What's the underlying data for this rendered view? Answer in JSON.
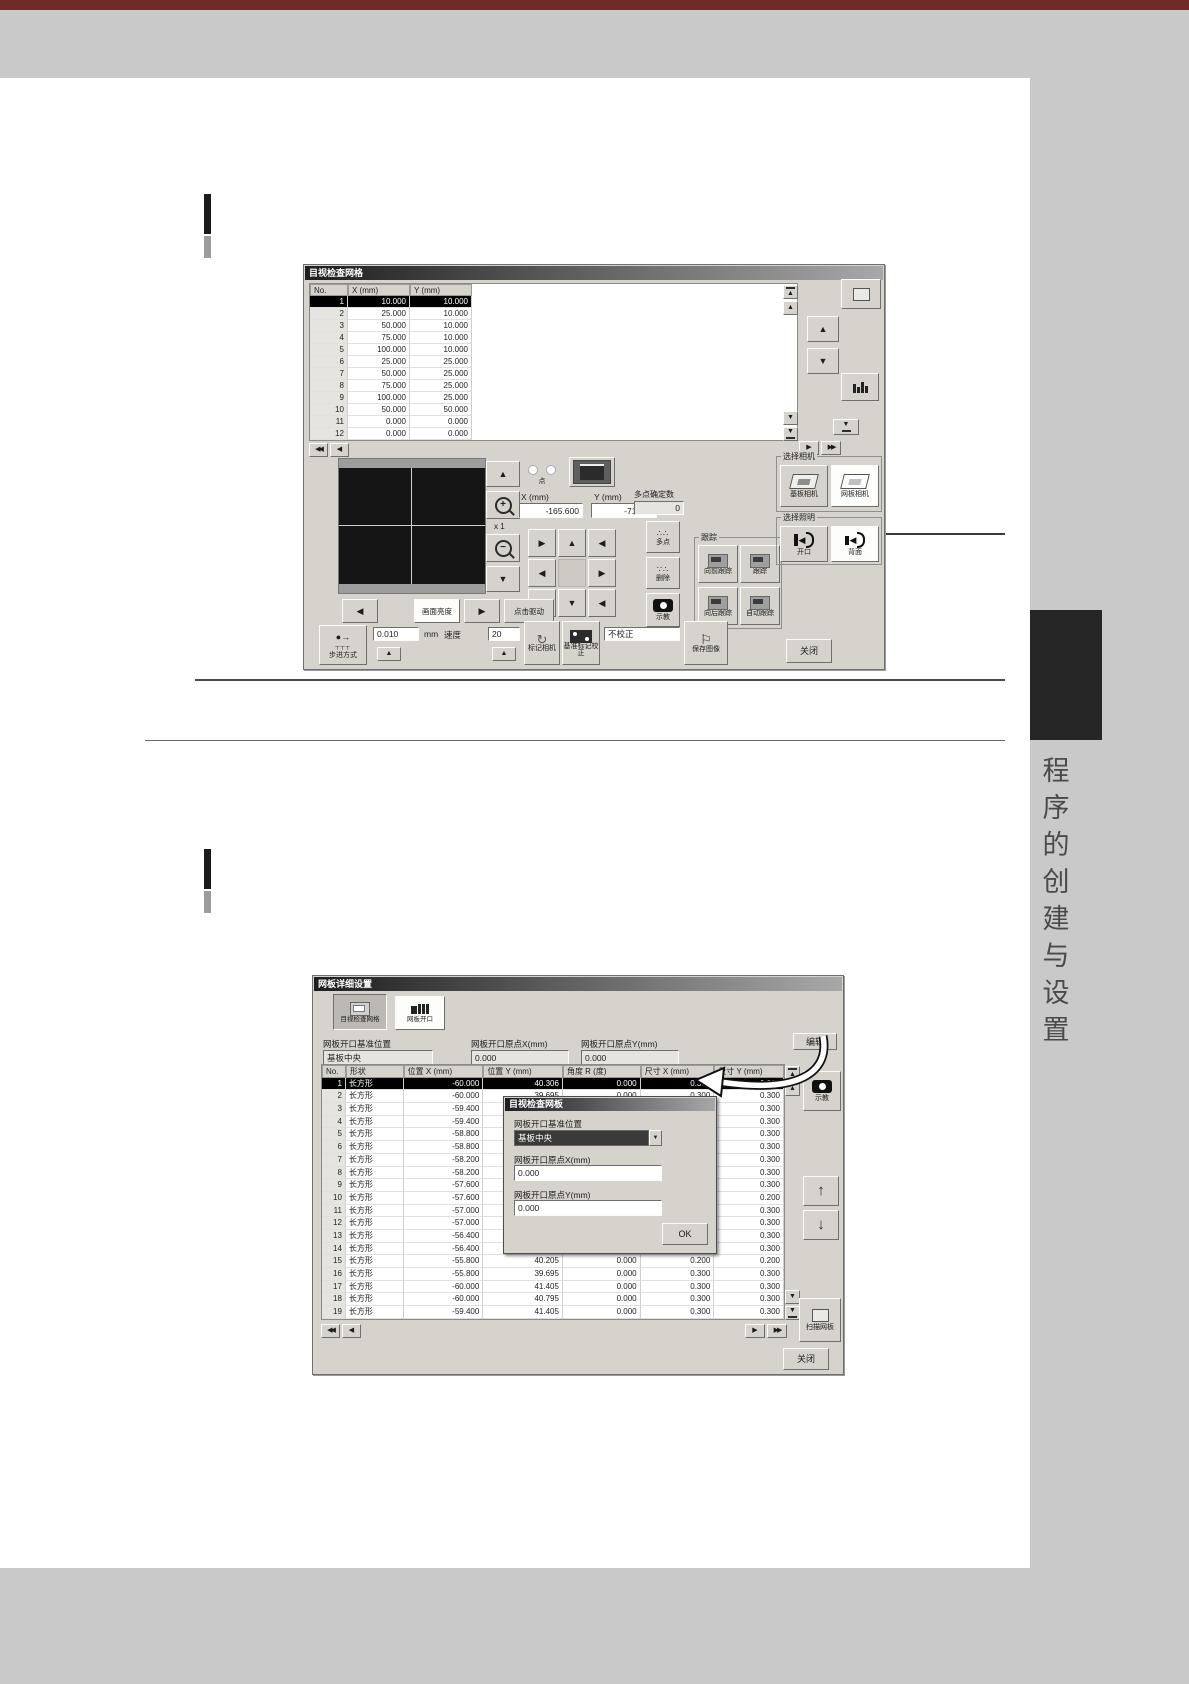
{
  "page": {
    "sidebar_chars": [
      "程",
      "序",
      "的",
      "创",
      "建",
      "与",
      "设",
      "置"
    ]
  },
  "icons": {
    "up": "▲",
    "down": "▼",
    "left": "◀",
    "right": "▶",
    "up_arrow": "↑",
    "down_arrow": "↓",
    "plus": "+",
    "minus": "−",
    "refresh": "↻",
    "flag": "⚐",
    "step": "●→"
  },
  "shot1": {
    "title": "目视检查网格",
    "table": {
      "headers": [
        "No.",
        "X (mm)",
        "Y (mm)"
      ],
      "rows": [
        [
          "1",
          "10.000",
          "10.000"
        ],
        [
          "2",
          "25.000",
          "10.000"
        ],
        [
          "3",
          "50.000",
          "10.000"
        ],
        [
          "4",
          "75.000",
          "10.000"
        ],
        [
          "5",
          "100.000",
          "10.000"
        ],
        [
          "6",
          "25.000",
          "25.000"
        ],
        [
          "7",
          "50.000",
          "25.000"
        ],
        [
          "8",
          "75.000",
          "25.000"
        ],
        [
          "9",
          "100.000",
          "25.000"
        ],
        [
          "10",
          "50.000",
          "50.000"
        ],
        [
          "11",
          "0.000",
          "0.000"
        ],
        [
          "12",
          "0.000",
          "0.000"
        ]
      ]
    },
    "pos": {
      "dot_label": "点",
      "x_label": "X (mm)",
      "x_value": "-165.600",
      "y_label": "Y (mm)",
      "y_value": "-71.004",
      "multi_label": "多点确定数",
      "multi_value": "0"
    },
    "zoom_scale": "x 1",
    "buttons": {
      "brightness": "画面亮度",
      "click_drive": "点击驱动",
      "multi_point": "多点",
      "delete": "删除",
      "teach": "示教",
      "step_mode": "步进方式",
      "step_value": "0.010",
      "unit": "mm",
      "speed_label": "速度",
      "speed_value": "20",
      "mark_camera": "标记相机",
      "fid_correct": "基准标记校正",
      "no_correct": "不校正",
      "save_image": "保存图像",
      "close": "关闭"
    },
    "groups": {
      "tracking": {
        "label": "跟踪",
        "items": [
          "向前跟踪",
          "跟踪",
          "向后跟踪",
          "自动跟踪"
        ]
      },
      "camera": {
        "label": "选择相机",
        "items": [
          "基板相机",
          "网板相机"
        ]
      },
      "light": {
        "label": "选择照明",
        "items": [
          "开口",
          "背面"
        ]
      }
    }
  },
  "shot2": {
    "title": "网板详细设置",
    "toolbar": {
      "btn_grid": "目视检查网格",
      "btn_aperture": "网板开口"
    },
    "header": {
      "ref_label": "网板开口基准位置",
      "ref_value": "基板中央",
      "ox_label": "网板开口原点X(mm)",
      "ox_value": "0.000",
      "oy_label": "网板开口原点Y(mm)",
      "oy_value": "0.000",
      "edit": "编辑"
    },
    "table": {
      "headers": [
        "No.",
        "形状",
        "位置 X (mm)",
        "位置 Y (mm)",
        "角度 R (度)",
        "尺寸 X (mm)",
        "尺寸 Y (mm)"
      ],
      "rows": [
        [
          "1",
          "长方形",
          "-60.000",
          "40.306",
          "0.000",
          "0.300",
          "0.300"
        ],
        [
          "2",
          "长方形",
          "-60.000",
          "39.695",
          "0.000",
          "0.300",
          "0.300"
        ],
        [
          "3",
          "长方形",
          "-59.400",
          "",
          "",
          "0.300",
          "0.300"
        ],
        [
          "4",
          "长方形",
          "-59.400",
          "",
          "",
          "0.300",
          "0.300"
        ],
        [
          "5",
          "长方形",
          "-58.800",
          "",
          "",
          "0.300",
          "0.300"
        ],
        [
          "6",
          "长方形",
          "-58.800",
          "",
          "",
          "0.300",
          "0.300"
        ],
        [
          "7",
          "长方形",
          "-58.200",
          "",
          "",
          "0.300",
          "0.300"
        ],
        [
          "8",
          "长方形",
          "-58.200",
          "",
          "",
          "0.300",
          "0.300"
        ],
        [
          "9",
          "长方形",
          "-57.600",
          "",
          "",
          "0.300",
          "0.300"
        ],
        [
          "10",
          "长方形",
          "-57.600",
          "",
          "",
          "0.200",
          "0.200"
        ],
        [
          "11",
          "长方形",
          "-57.000",
          "",
          "",
          "0.300",
          "0.300"
        ],
        [
          "12",
          "长方形",
          "-57.000",
          "",
          "",
          "0.300",
          "0.300"
        ],
        [
          "13",
          "长方形",
          "-56.400",
          "",
          "",
          "0.300",
          "0.300"
        ],
        [
          "14",
          "长方形",
          "-56.400",
          "",
          "",
          "0.300",
          "0.300"
        ],
        [
          "15",
          "长方形",
          "-55.800",
          "40.205",
          "0.000",
          "0.200",
          "0.200"
        ],
        [
          "16",
          "长方形",
          "-55.800",
          "39.695",
          "0.000",
          "0.300",
          "0.300"
        ],
        [
          "17",
          "长方形",
          "-60.000",
          "41.405",
          "0.000",
          "0.300",
          "0.300"
        ],
        [
          "18",
          "长方形",
          "-60.000",
          "40.795",
          "0.000",
          "0.300",
          "0.300"
        ],
        [
          "19",
          "长方形",
          "-59.400",
          "41.405",
          "0.000",
          "0.300",
          "0.300"
        ]
      ]
    },
    "dialog": {
      "title": "目视检查网板",
      "ref_label": "网板开口基准位置",
      "ref_value": "基板中央",
      "ox_label": "网板开口原点X(mm)",
      "ox_value": "0.000",
      "oy_label": "网板开口原点Y(mm)",
      "oy_value": "0.000",
      "ok": "OK"
    },
    "side": {
      "teach": "示教",
      "scan": "扫描网板",
      "close": "关闭"
    }
  }
}
